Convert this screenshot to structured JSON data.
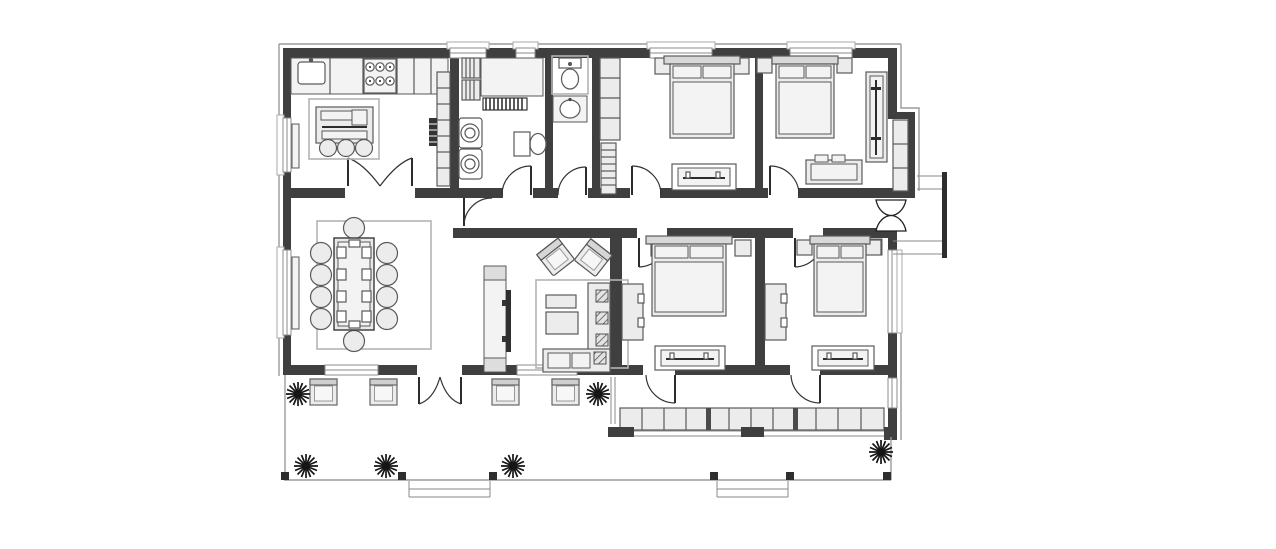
{
  "document": {
    "type": "architectural-floor-plan",
    "view": "top-down",
    "style": "monochrome line drawing, no text labels"
  },
  "palette": {
    "background": "#ffffff",
    "wall": "#3f3f3f",
    "furnitureFill": "#ececec",
    "furnitureStroke": "#5a5a5a",
    "lightFill": "#f3f3f3",
    "thinLine": "#888888",
    "rugLine": "#b4b4b4",
    "accentDark": "#2e2e2e"
  },
  "rooms": [
    {
      "id": "kitchen",
      "position": "top-left",
      "furniture": [
        "counter-with-sink",
        "six-burner-stove",
        "tall-cabinet-column",
        "island-with-three-stools",
        "double-door-to-dining"
      ]
    },
    {
      "id": "laundry-room",
      "position": "top-center-left",
      "furniture": [
        "slatted-shelving",
        "counter",
        "radiator",
        "two-stacked-washing-machines",
        "toilet"
      ]
    },
    {
      "id": "wc",
      "position": "top-center",
      "furniture": [
        "toilet",
        "washbasin"
      ]
    },
    {
      "id": "bedroom-top-left",
      "furniture": [
        "double-bed",
        "two-nightstands",
        "wardrobe-column",
        "ladder-shelf",
        "foot-bench"
      ]
    },
    {
      "id": "bedroom-top-right",
      "furniture": [
        "double-bed",
        "two-nightstands",
        "dresser",
        "sliding-wardrobe",
        "built-in-closet"
      ]
    },
    {
      "id": "dining-room",
      "position": "middle-left",
      "furniture": [
        "long-table",
        "ten-round-chairs",
        "rug",
        "window-radiator"
      ]
    },
    {
      "id": "living-room",
      "position": "center",
      "furniture": [
        "tv-console",
        "two-angled-armchairs",
        "two-coffee-tables",
        "corner-sofa-with-cushions",
        "rug"
      ]
    },
    {
      "id": "bedroom-bottom-left",
      "furniture": [
        "double-bed",
        "two-nightstands",
        "closet",
        "foot-bench"
      ]
    },
    {
      "id": "bedroom-bottom-right",
      "furniture": [
        "double-bed",
        "two-nightstands",
        "closet",
        "foot-bench"
      ]
    },
    {
      "id": "hallway",
      "position": "central-band",
      "furniture": []
    },
    {
      "id": "south-corridor",
      "furniture": [
        "built-in-wardrobe-row-12-cells"
      ]
    }
  ],
  "outdoor": {
    "terrace": {
      "armchairs": 4,
      "plants": 6,
      "corner-posts": 6,
      "step-openings": 2
    },
    "entrance": {
      "double-swing-door": 1,
      "exterior-steps": 1,
      "landing-rail": 1
    }
  },
  "counts": {
    "windows": 10,
    "interior-door-swings": 10,
    "double-doors": 3
  }
}
